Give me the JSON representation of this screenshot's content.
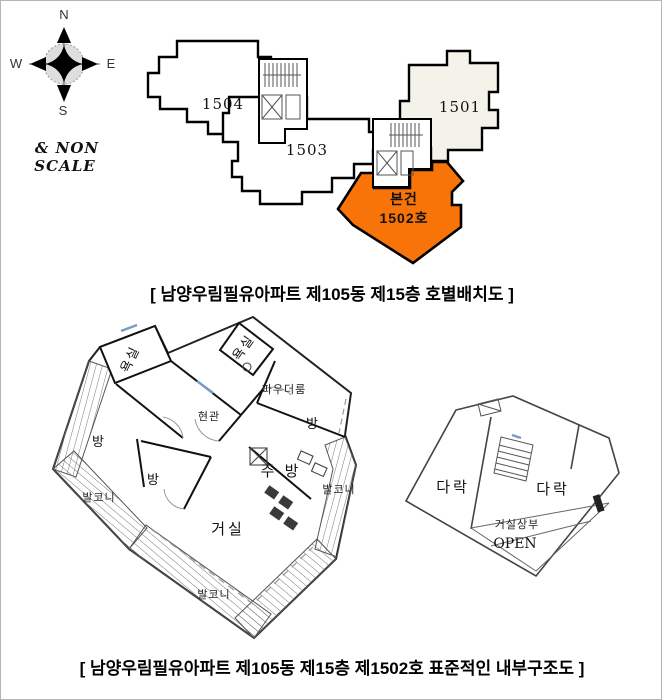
{
  "compass": {
    "north": "N",
    "south": "S",
    "east": "E",
    "west": "W"
  },
  "scale_note": {
    "line1": "& NON",
    "line2": "SCALE"
  },
  "site_plan": {
    "unit_1504": "1504",
    "unit_1503": "1503",
    "unit_1501": "1501",
    "subject_line1": "본건",
    "subject_line2": "1502호",
    "highlight_color": "#F87408",
    "neighbor_fill": "#F4F3EA"
  },
  "captions": {
    "top": "[ 남양우림필유아파트 제105동 제15층 호별배치도 ]",
    "bottom": "[ 남양우림필유아파트 제105동 제15층 제1502호 표준적인 내부구조도 ]"
  },
  "unit_plan": {
    "bath_1": "욕실",
    "bath_2": "욕실",
    "powder_room": "파우더룸",
    "entrance": "현관",
    "room_1": "방",
    "room_2": "방",
    "room_3": "방",
    "kitchen": "주 방",
    "living_room": "거실",
    "balcony_left": "발코니",
    "balcony_bottom": "발코니",
    "balcony_right": "발코니"
  },
  "attic_plan": {
    "attic_left": "다락",
    "attic_right": "다락",
    "open_label_line1": "거실상부",
    "open_label_line2": "OPEN"
  }
}
